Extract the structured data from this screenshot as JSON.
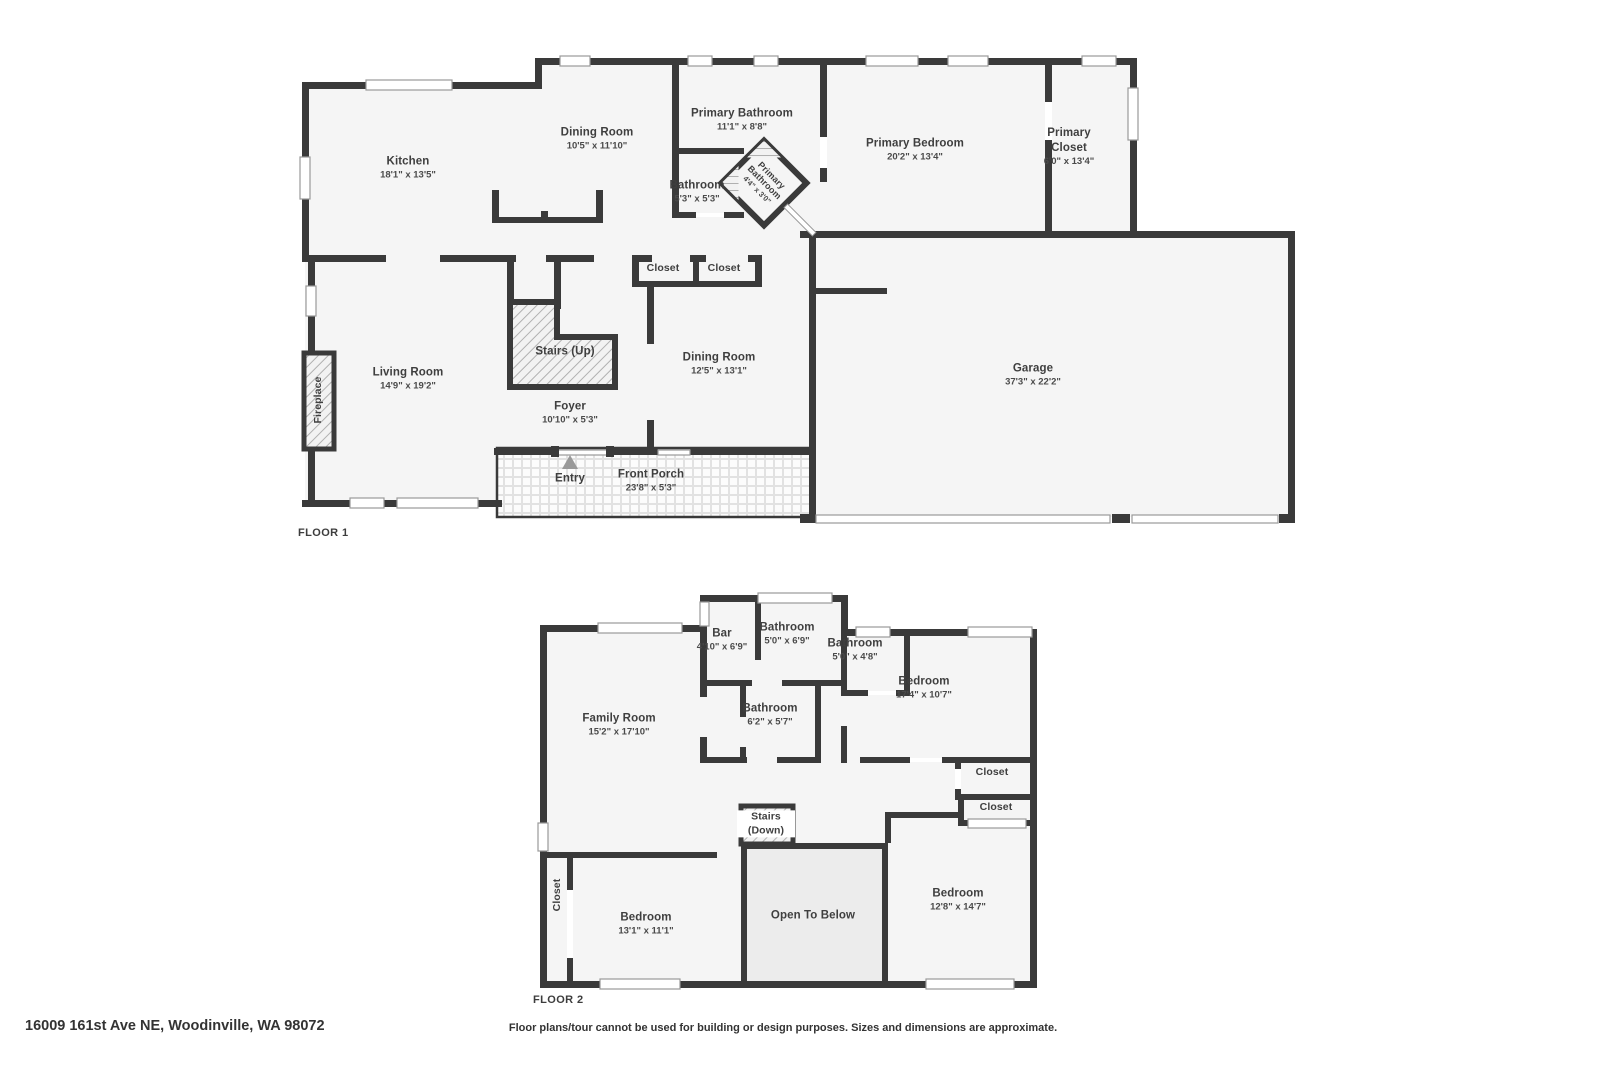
{
  "colors": {
    "wall": "#3a3a3a",
    "room_fill": "#f5f5f5",
    "open_below_fill": "#ececec",
    "hatch_line": "#b5b5b5",
    "text": "#3f3f3f"
  },
  "floor1": {
    "label": "FLOOR 1",
    "rooms": [
      {
        "name": "Kitchen",
        "dims": "18'1\" x 13'5\""
      },
      {
        "name": "Dining Room",
        "dims": "10'5\" x 11'10\""
      },
      {
        "name": "Primary Bathroom",
        "dims": "11'1\" x 8'8\""
      },
      {
        "name": "Primary Bedroom",
        "dims": "20'2\" x 13'4\""
      },
      {
        "name": "Primary Closet",
        "dims": "6'0\" x 13'4\""
      },
      {
        "name": "Bathroom",
        "dims": "5'3\" x 5'3\""
      },
      {
        "name": "Primary Bathroom",
        "dims": "4'4\" x 3'0\""
      },
      {
        "name": "Closet",
        "dims": ""
      },
      {
        "name": "Closet",
        "dims": ""
      },
      {
        "name": "Dining Room",
        "dims": "12'5\" x 13'1\""
      },
      {
        "name": "Living Room",
        "dims": "14'9\" x 19'2\""
      },
      {
        "name": "Stairs (Up)",
        "dims": ""
      },
      {
        "name": "Foyer",
        "dims": "10'10\" x 5'3\""
      },
      {
        "name": "Entry",
        "dims": ""
      },
      {
        "name": "Front Porch",
        "dims": "23'8\" x 5'3\""
      },
      {
        "name": "Garage",
        "dims": "37'3\" x 22'2\""
      },
      {
        "name": "Fireplace",
        "dims": ""
      }
    ]
  },
  "floor2": {
    "label": "FLOOR 2",
    "rooms": [
      {
        "name": "Bar",
        "dims": "4'10\" x 6'9\""
      },
      {
        "name": "Bathroom",
        "dims": "5'0\" x 6'9\""
      },
      {
        "name": "Bathroom",
        "dims": "5'0\" x 4'8\""
      },
      {
        "name": "Bedroom",
        "dims": "17'4\" x 10'7\""
      },
      {
        "name": "Family Room",
        "dims": "15'2\" x 17'10\""
      },
      {
        "name": "Bathroom",
        "dims": "6'2\" x 5'7\""
      },
      {
        "name": "Closet",
        "dims": ""
      },
      {
        "name": "Closet",
        "dims": ""
      },
      {
        "name": "Stairs (Down)",
        "dims": ""
      },
      {
        "name": "Bedroom",
        "dims": "13'1\" x 11'1\""
      },
      {
        "name": "Open To Below",
        "dims": ""
      },
      {
        "name": "Bedroom",
        "dims": "12'8\" x 14'7\""
      },
      {
        "name": "Closet",
        "dims": ""
      }
    ]
  },
  "footer": {
    "address": "16009 161st Ave NE, Woodinville, WA 98072",
    "disclaimer": "Floor plans/tour cannot be used for building or design purposes. Sizes and dimensions are approximate."
  }
}
